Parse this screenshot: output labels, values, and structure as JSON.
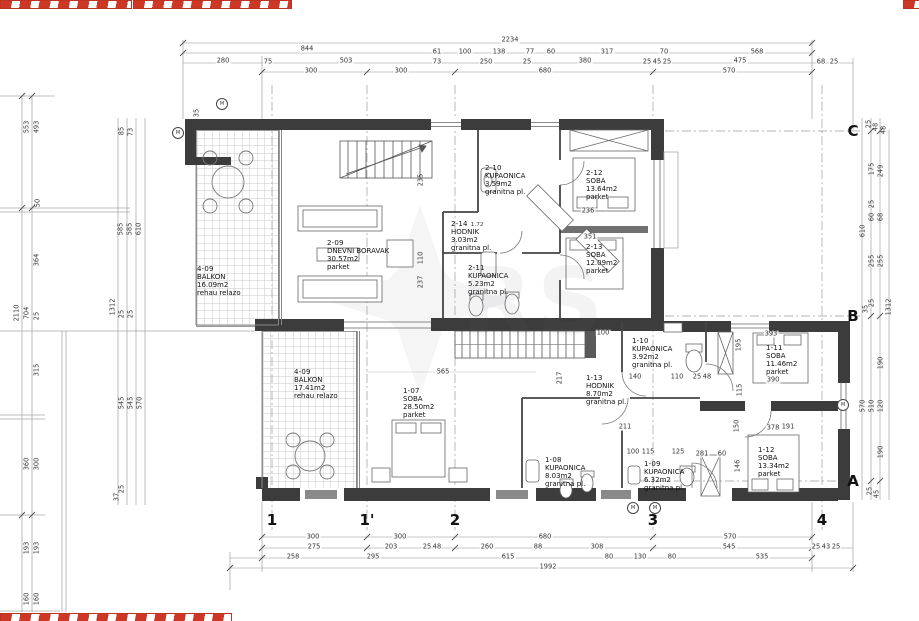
{
  "watermark": {
    "text": "RS"
  },
  "rooms": [
    {
      "id": "4-09",
      "name": "BALKON",
      "area": "16.09m2",
      "floor": "rehau relazo",
      "x": 197,
      "y": 265
    },
    {
      "id": "2-09",
      "name": "DNEVNI BORAVAK",
      "area": "30.57m2",
      "floor": "parket",
      "x": 327,
      "y": 239
    },
    {
      "id": "2-10",
      "name": "KUPAONICA",
      "area": "3.59m2",
      "floor": "granitna pl.",
      "x": 485,
      "y": 164
    },
    {
      "id": "2-14",
      "name": "HODNIK",
      "area": "3.03m2",
      "floor": "granitna pl.",
      "extra": "1.72",
      "x": 451,
      "y": 220
    },
    {
      "id": "2-11",
      "name": "KUPAONICA",
      "area": "5.23m2",
      "floor": "granitna pl.",
      "x": 468,
      "y": 264
    },
    {
      "id": "2-12",
      "name": "SOBA",
      "area": "13.64m2",
      "floor": "parket",
      "x": 586,
      "y": 169
    },
    {
      "id": "2-13",
      "name": "SOBA",
      "area": "12.09m2",
      "floor": "parket",
      "x": 586,
      "y": 243
    },
    {
      "id": "4-09",
      "name": "BALKON",
      "area": "17.41m2",
      "floor": "rehau relazo",
      "x": 294,
      "y": 368
    },
    {
      "id": "1-07",
      "name": "SOBA",
      "area": "28.50m2",
      "floor": "parket",
      "x": 403,
      "y": 387
    },
    {
      "id": "1-13",
      "name": "HODNIK",
      "area": "8.70m2",
      "floor": "granitna pl.",
      "x": 586,
      "y": 374
    },
    {
      "id": "1-10",
      "name": "KUPAONICA",
      "area": "3.92m2",
      "floor": "granitna pl.",
      "x": 632,
      "y": 337
    },
    {
      "id": "1-11",
      "name": "SOBA",
      "area": "11.46m2",
      "floor": "parket",
      "x": 766,
      "y": 344
    },
    {
      "id": "1-12",
      "name": "SOBA",
      "area": "13.34m2",
      "floor": "parket",
      "x": 758,
      "y": 446
    },
    {
      "id": "1-08",
      "name": "KUPAONICA",
      "area": "8.03m2",
      "floor": "granitna pl.",
      "x": 545,
      "y": 456
    },
    {
      "id": "1-09",
      "name": "KUPAONICA",
      "area": "6.32m2",
      "floor": "granitna pl.",
      "x": 644,
      "y": 460
    }
  ],
  "grid": {
    "columns": [
      {
        "label": "1",
        "x": 272
      },
      {
        "label": "1'",
        "x": 367
      },
      {
        "label": "2",
        "x": 455
      },
      {
        "label": "3",
        "x": 653
      },
      {
        "label": "4",
        "x": 822
      }
    ],
    "rows": [
      {
        "label": "C",
        "y": 131
      },
      {
        "label": "B",
        "y": 316
      },
      {
        "label": "A",
        "y": 481
      }
    ]
  },
  "markers": [
    {
      "label": "M",
      "x": 222,
      "y": 104
    },
    {
      "label": "M",
      "x": 178,
      "y": 133
    },
    {
      "label": "M",
      "x": 633,
      "y": 508
    },
    {
      "label": "M",
      "x": 655,
      "y": 508
    },
    {
      "label": "M",
      "x": 843,
      "y": 405
    }
  ],
  "dimensions": [
    {
      "t": "2234",
      "x": 510,
      "y": 40
    },
    {
      "t": "844",
      "x": 307,
      "y": 49
    },
    {
      "t": "61",
      "x": 437,
      "y": 52
    },
    {
      "t": "100",
      "x": 465,
      "y": 52
    },
    {
      "t": "138",
      "x": 499,
      "y": 52
    },
    {
      "t": "77",
      "x": 530,
      "y": 52
    },
    {
      "t": "60",
      "x": 551,
      "y": 52
    },
    {
      "t": "317",
      "x": 607,
      "y": 52
    },
    {
      "t": "70",
      "x": 664,
      "y": 52
    },
    {
      "t": "568",
      "x": 757,
      "y": 52
    },
    {
      "t": "280",
      "x": 223,
      "y": 61
    },
    {
      "t": "75",
      "x": 268,
      "y": 62
    },
    {
      "t": "503",
      "x": 346,
      "y": 61
    },
    {
      "t": "73",
      "x": 437,
      "y": 62
    },
    {
      "t": "250",
      "x": 486,
      "y": 62
    },
    {
      "t": "25",
      "x": 527,
      "y": 62
    },
    {
      "t": "380",
      "x": 585,
      "y": 61
    },
    {
      "t": "25",
      "x": 647,
      "y": 62
    },
    {
      "t": "45",
      "x": 657,
      "y": 62
    },
    {
      "t": "25",
      "x": 667,
      "y": 62
    },
    {
      "t": "475",
      "x": 740,
      "y": 61
    },
    {
      "t": "68",
      "x": 821,
      "y": 62
    },
    {
      "t": "25",
      "x": 834,
      "y": 62
    },
    {
      "t": "300",
      "x": 311,
      "y": 71
    },
    {
      "t": "300",
      "x": 401,
      "y": 71
    },
    {
      "t": "680",
      "x": 545,
      "y": 71
    },
    {
      "t": "570",
      "x": 729,
      "y": 71
    },
    {
      "t": "300",
      "x": 313,
      "y": 537
    },
    {
      "t": "300",
      "x": 400,
      "y": 537
    },
    {
      "t": "680",
      "x": 545,
      "y": 537
    },
    {
      "t": "570",
      "x": 730,
      "y": 537
    },
    {
      "t": "275",
      "x": 314,
      "y": 547
    },
    {
      "t": "203",
      "x": 391,
      "y": 547
    },
    {
      "t": "25",
      "x": 427,
      "y": 547
    },
    {
      "t": "48",
      "x": 437,
      "y": 547
    },
    {
      "t": "260",
      "x": 487,
      "y": 547
    },
    {
      "t": "88",
      "x": 538,
      "y": 547
    },
    {
      "t": "308",
      "x": 597,
      "y": 547
    },
    {
      "t": "545",
      "x": 729,
      "y": 547
    },
    {
      "t": "25",
      "x": 816,
      "y": 547
    },
    {
      "t": "43",
      "x": 826,
      "y": 547
    },
    {
      "t": "25",
      "x": 836,
      "y": 547
    },
    {
      "t": "258",
      "x": 293,
      "y": 557
    },
    {
      "t": "295",
      "x": 373,
      "y": 557
    },
    {
      "t": "615",
      "x": 508,
      "y": 557
    },
    {
      "t": "80",
      "x": 609,
      "y": 557
    },
    {
      "t": "130",
      "x": 640,
      "y": 557
    },
    {
      "t": "80",
      "x": 672,
      "y": 557
    },
    {
      "t": "535",
      "x": 762,
      "y": 557
    },
    {
      "t": "1992",
      "x": 548,
      "y": 567
    },
    {
      "t": "553",
      "x": 27,
      "y": 127,
      "v": 1
    },
    {
      "t": "493",
      "x": 37,
      "y": 127,
      "v": 1
    },
    {
      "t": "85",
      "x": 122,
      "y": 131,
      "v": 1
    },
    {
      "t": "73",
      "x": 131,
      "y": 132,
      "v": 1
    },
    {
      "t": "35",
      "x": 197,
      "y": 113,
      "v": 1
    },
    {
      "t": "50",
      "x": 38,
      "y": 203,
      "v": 1
    },
    {
      "t": "585",
      "x": 121,
      "y": 229,
      "v": 1
    },
    {
      "t": "585",
      "x": 130,
      "y": 229,
      "v": 1
    },
    {
      "t": "610",
      "x": 139,
      "y": 229,
      "v": 1
    },
    {
      "t": "364",
      "x": 37,
      "y": 260,
      "v": 1
    },
    {
      "t": "2110",
      "x": 17,
      "y": 313,
      "v": 1
    },
    {
      "t": "704",
      "x": 27,
      "y": 313,
      "v": 1
    },
    {
      "t": "25",
      "x": 37,
      "y": 316,
      "v": 1
    },
    {
      "t": "1312",
      "x": 113,
      "y": 307,
      "v": 1
    },
    {
      "t": "25",
      "x": 122,
      "y": 314,
      "v": 1
    },
    {
      "t": "25",
      "x": 131,
      "y": 314,
      "v": 1
    },
    {
      "t": "315",
      "x": 37,
      "y": 370,
      "v": 1
    },
    {
      "t": "545",
      "x": 122,
      "y": 403,
      "v": 1
    },
    {
      "t": "545",
      "x": 131,
      "y": 403,
      "v": 1
    },
    {
      "t": "570",
      "x": 140,
      "y": 403,
      "v": 1
    },
    {
      "t": "360",
      "x": 27,
      "y": 464,
      "v": 1
    },
    {
      "t": "300",
      "x": 37,
      "y": 464,
      "v": 1
    },
    {
      "t": "25",
      "x": 122,
      "y": 489,
      "v": 1
    },
    {
      "t": "37",
      "x": 117,
      "y": 497,
      "v": 1
    },
    {
      "t": "193",
      "x": 27,
      "y": 548,
      "v": 1
    },
    {
      "t": "193",
      "x": 37,
      "y": 548,
      "v": 1
    },
    {
      "t": "160",
      "x": 27,
      "y": 599,
      "v": 1
    },
    {
      "t": "160",
      "x": 37,
      "y": 599,
      "v": 1
    },
    {
      "t": "25",
      "x": 869,
      "y": 124,
      "v": 1
    },
    {
      "t": "48",
      "x": 876,
      "y": 127,
      "v": 1
    },
    {
      "t": "48",
      "x": 884,
      "y": 130,
      "v": 1
    },
    {
      "t": "175",
      "x": 872,
      "y": 169,
      "v": 1
    },
    {
      "t": "249",
      "x": 881,
      "y": 171,
      "v": 1
    },
    {
      "t": "25",
      "x": 872,
      "y": 204,
      "v": 1
    },
    {
      "t": "60",
      "x": 872,
      "y": 217,
      "v": 1
    },
    {
      "t": "68",
      "x": 881,
      "y": 217,
      "v": 1
    },
    {
      "t": "610",
      "x": 863,
      "y": 231,
      "v": 1
    },
    {
      "t": "255",
      "x": 872,
      "y": 261,
      "v": 1
    },
    {
      "t": "255",
      "x": 881,
      "y": 261,
      "v": 1
    },
    {
      "t": "35",
      "x": 866,
      "y": 309,
      "v": 1
    },
    {
      "t": "25",
      "x": 872,
      "y": 303,
      "v": 1
    },
    {
      "t": "1312",
      "x": 889,
      "y": 307,
      "v": 1
    },
    {
      "t": "190",
      "x": 881,
      "y": 363,
      "v": 1
    },
    {
      "t": "570",
      "x": 863,
      "y": 406,
      "v": 1
    },
    {
      "t": "510",
      "x": 872,
      "y": 406,
      "v": 1
    },
    {
      "t": "120",
      "x": 881,
      "y": 406,
      "v": 1
    },
    {
      "t": "190",
      "x": 881,
      "y": 452,
      "v": 1
    },
    {
      "t": "25",
      "x": 870,
      "y": 491,
      "v": 1
    },
    {
      "t": "45",
      "x": 877,
      "y": 494,
      "v": 1
    },
    {
      "t": "565",
      "x": 443,
      "y": 372
    },
    {
      "t": "236",
      "x": 588,
      "y": 211
    },
    {
      "t": "351",
      "x": 590,
      "y": 237
    },
    {
      "t": "100",
      "x": 603,
      "y": 333
    },
    {
      "t": "140",
      "x": 635,
      "y": 377
    },
    {
      "t": "110",
      "x": 677,
      "y": 377
    },
    {
      "t": "25",
      "x": 697,
      "y": 377
    },
    {
      "t": "48",
      "x": 707,
      "y": 377
    },
    {
      "t": "217",
      "x": 560,
      "y": 378,
      "v": 1
    },
    {
      "t": "115",
      "x": 740,
      "y": 390,
      "v": 1
    },
    {
      "t": "211",
      "x": 625,
      "y": 427
    },
    {
      "t": "191",
      "x": 788,
      "y": 427
    },
    {
      "t": "100",
      "x": 633,
      "y": 452
    },
    {
      "t": "115",
      "x": 648,
      "y": 452
    },
    {
      "t": "125",
      "x": 678,
      "y": 452
    },
    {
      "t": "281",
      "x": 702,
      "y": 454
    },
    {
      "t": "60",
      "x": 722,
      "y": 454
    },
    {
      "t": "195",
      "x": 739,
      "y": 345,
      "v": 1
    },
    {
      "t": "393",
      "x": 771,
      "y": 334
    },
    {
      "t": "390",
      "x": 773,
      "y": 380
    },
    {
      "t": "150",
      "x": 737,
      "y": 426,
      "v": 1
    },
    {
      "t": "378",
      "x": 773,
      "y": 428
    },
    {
      "t": "146",
      "x": 738,
      "y": 466,
      "v": 1
    },
    {
      "t": "235",
      "x": 421,
      "y": 180,
      "v": 1
    },
    {
      "t": "110",
      "x": 421,
      "y": 258,
      "v": 1
    },
    {
      "t": "237",
      "x": 421,
      "y": 282,
      "v": 1
    }
  ]
}
